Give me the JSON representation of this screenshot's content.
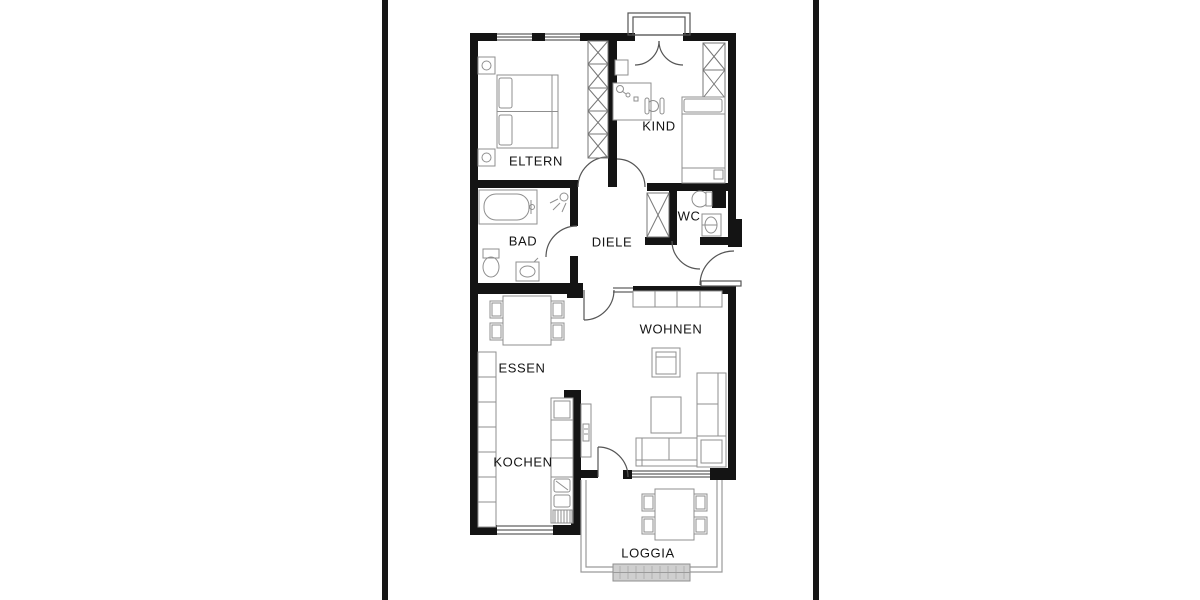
{
  "document": {
    "kind": "apartment floor plan drawing",
    "language": "de"
  },
  "colors": {
    "background": "#ffffff",
    "wall": "#141414",
    "page_edge": "#161616",
    "furniture_line": "#8f8f8f",
    "door_line": "#555555",
    "label_text": "#141414"
  },
  "floor_plan": {
    "rooms": [
      {
        "id": "eltern",
        "label": "ELTERN"
      },
      {
        "id": "kind",
        "label": "KIND"
      },
      {
        "id": "bad",
        "label": "BAD"
      },
      {
        "id": "diele",
        "label": "DIELE"
      },
      {
        "id": "wc",
        "label": "WC"
      },
      {
        "id": "essen",
        "label": "ESSEN"
      },
      {
        "id": "wohnen",
        "label": "WOHNEN"
      },
      {
        "id": "kochen",
        "label": "KOCHEN"
      },
      {
        "id": "loggia",
        "label": "LOGGIA"
      }
    ]
  }
}
